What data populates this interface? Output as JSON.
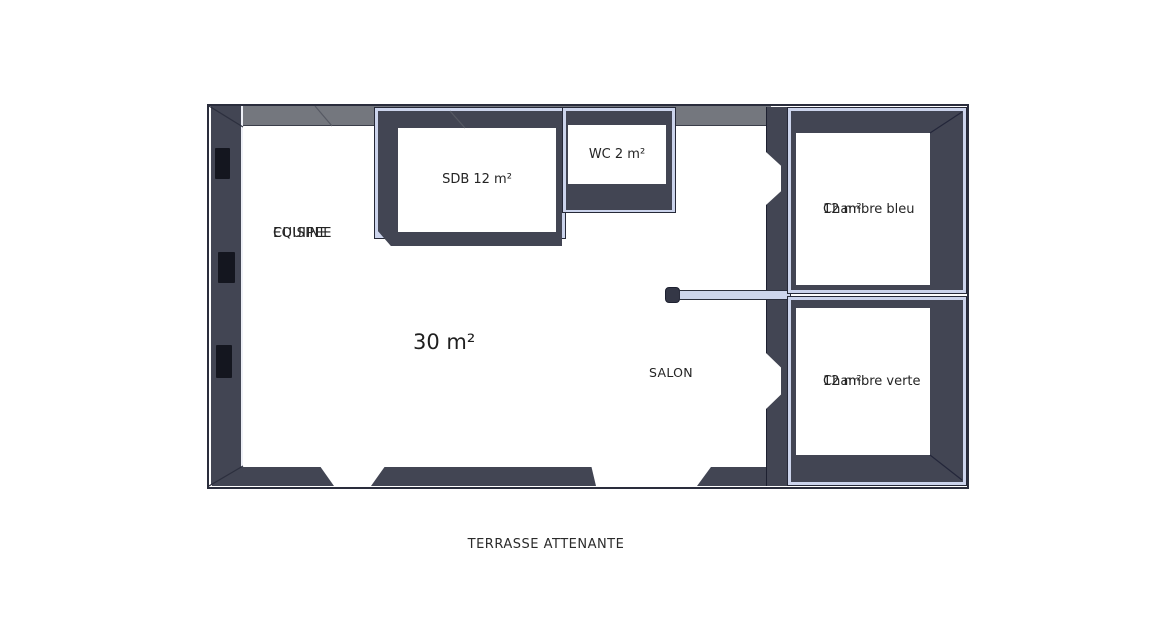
{
  "colors": {
    "wall": "#424553",
    "wall_top_face": "#74777e",
    "trim": "#ccd4ec",
    "outline": "#2a2d3c",
    "background": "#ffffff",
    "text": "#242424"
  },
  "plan": {
    "kitchen_line1": "CUISINE",
    "kitchen_line2": "EQUIPEE",
    "living_area_label": "30 m²",
    "salon_label": "SALON",
    "sdb_label": "SDB 12 m²",
    "wc_label": "WC 2 m²",
    "bedroom_blue_line1": "Chambre bleu",
    "bedroom_blue_line2": "12 m²",
    "bedroom_green_line1": "Chambre verte",
    "bedroom_green_line2": "12 m²",
    "terrace_label": "TERRASSE ATTENANTE"
  }
}
